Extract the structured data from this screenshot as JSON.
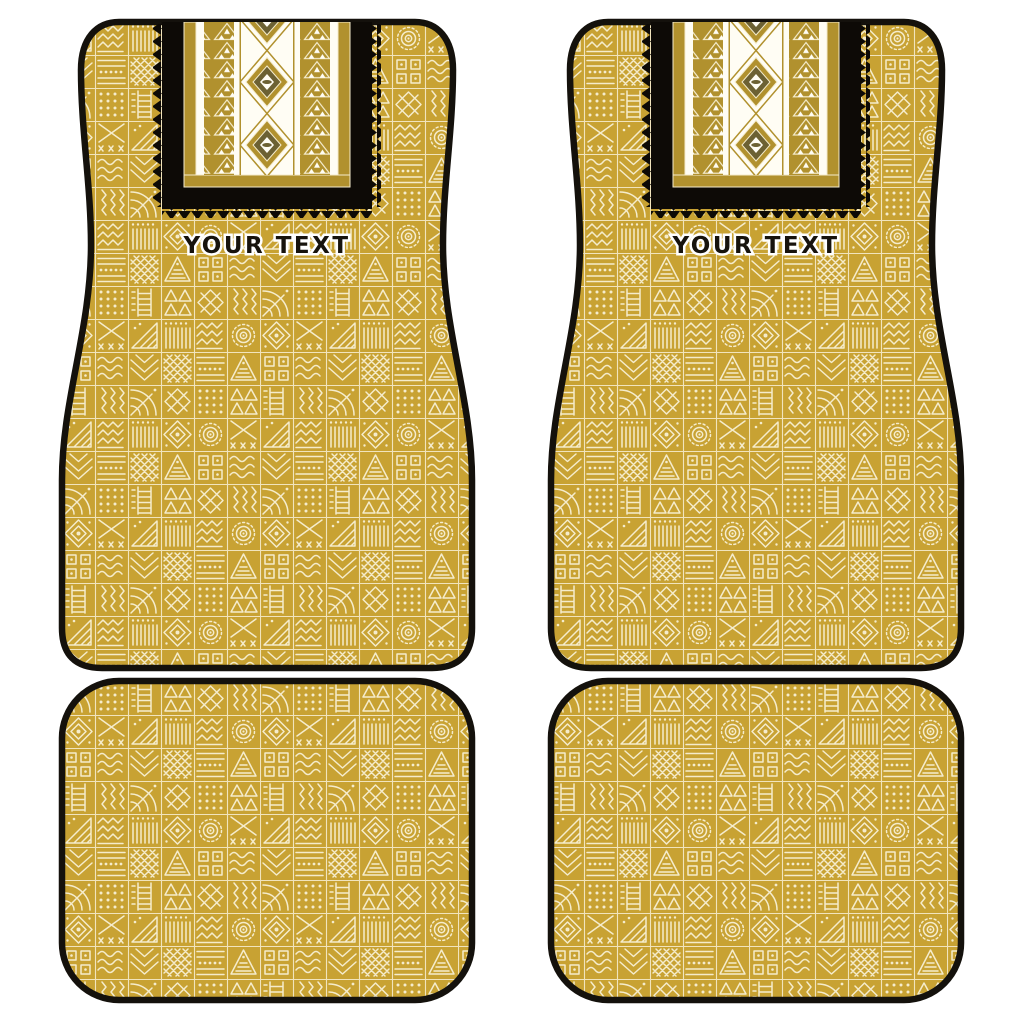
{
  "colors": {
    "page_bg": "#ffffff",
    "mat_gold": "#C8A233",
    "pattern_cream": "#F5ECCC",
    "band_gold": "#B1912E",
    "band_olive": "#6C6133",
    "warm_white": "#FFFDF4",
    "panel_black": "#0D0A06",
    "border_black": "#14110C",
    "text_black": "#17130D",
    "text_halo": "#FFFFFF"
  },
  "mats": {
    "front_left": {
      "label": "front-left-mat",
      "custom_text": "YOUR TEXT"
    },
    "front_right": {
      "label": "front-right-mat",
      "custom_text": "YOUR TEXT"
    },
    "rear_left": {
      "label": "rear-left-mat"
    },
    "rear_right": {
      "label": "rear-right-mat"
    }
  }
}
